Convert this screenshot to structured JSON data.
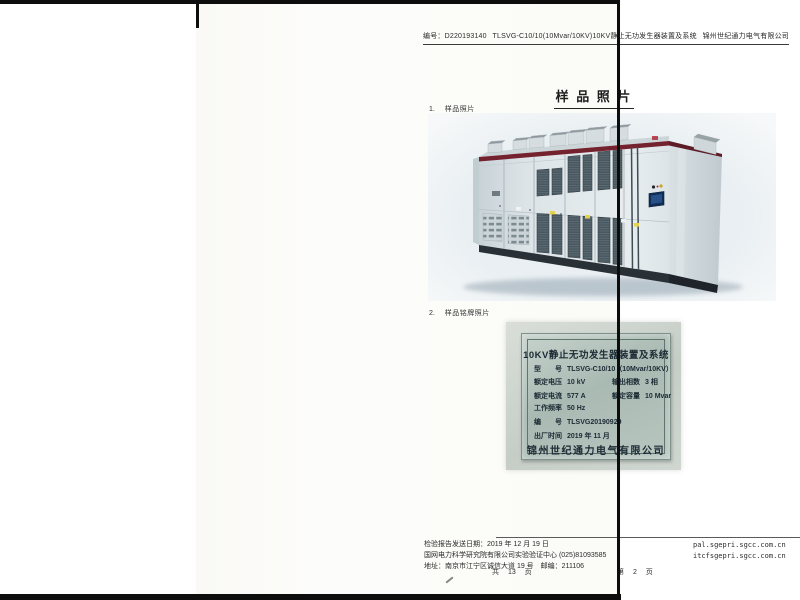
{
  "document": {
    "header": {
      "doc_number": "编号：D220193140",
      "title": "TLSVG-C10/10(10Mvar/10KV)10KV静止无功发生器装置及系统",
      "company": "锦州世纪通力电气有限公司"
    },
    "main_title": "样 品 照 片",
    "sections": [
      {
        "index": "1.",
        "label": "样品照片"
      },
      {
        "index": "2.",
        "label": "样品铭牌照片"
      }
    ],
    "nameplate": {
      "title": "10KV静止无功发生器装置及系统",
      "rows": [
        {
          "cells": [
            "型　　号",
            "TLSVG-C10/10（10Mvar/10KV）"
          ]
        },
        {
          "cells": [
            "额定电压",
            "10 kV",
            "输出相数",
            "3 相"
          ]
        },
        {
          "cells": [
            "额定电流",
            "577 A",
            "额定容量",
            "10 Mvar"
          ]
        },
        {
          "cells": [
            "工作频率",
            "50 Hz"
          ]
        },
        {
          "cells": [
            "编　　号",
            "TLSVG20190929"
          ]
        },
        {
          "cells": [
            "出厂时间",
            "2019 年 11 月"
          ]
        }
      ],
      "company": "锦州世纪通力电气有限公司"
    },
    "footer": {
      "left_lines": [
        "检验报告发送日期：2019 年 12 月 19 日",
        "国网电力科学研究院有限公司实验验证中心 (025)81093585",
        "地址：南京市江宁区诚信大道 19 号　邮编：211106"
      ],
      "pages_total": "共 13 页",
      "pages_current": "第 2 页",
      "right_lines": [
        "pal.sgepri.sgcc.com.cn",
        "itcfsgepri.sgcc.com.cn"
      ]
    },
    "colors": {
      "cabinet_top_band": "#73222e",
      "nameplate_metal": "#aebdb7",
      "photo_backdrop": "#e9eff2"
    }
  }
}
